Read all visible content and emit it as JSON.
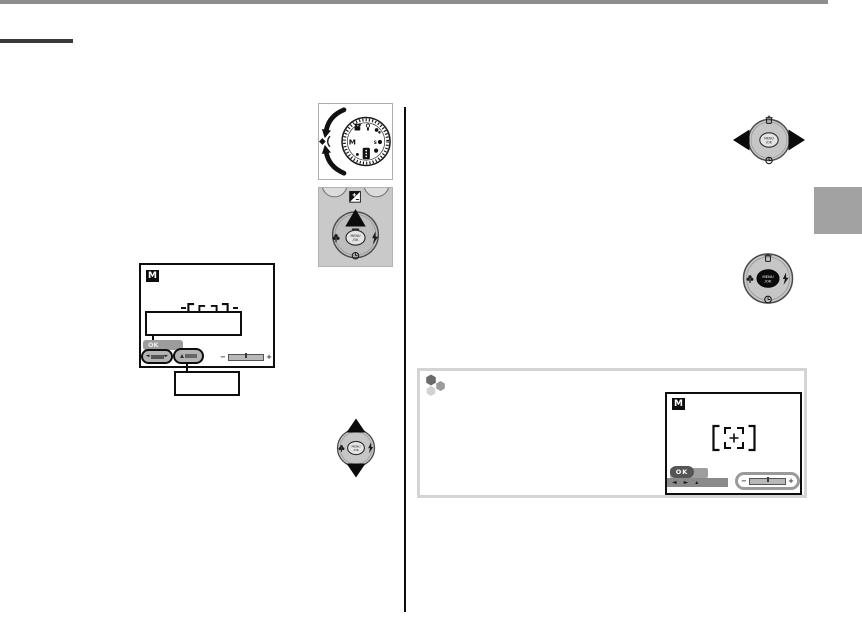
{
  "page": {
    "kind": "camera-manual-page",
    "colors": {
      "top_rule": "#8d8d8d",
      "heading_rule": "#3a3a3a",
      "divider": "#0d0d0d",
      "side_tab": "#a2a2a2",
      "tip_border": "#d4d4d4",
      "control_panel_bg": "#c9c9c9",
      "screen_border": "#0d0d0d"
    }
  },
  "labels": {
    "menu_line1": "MENU",
    "menu_line2": "/OK",
    "mode_m": "M",
    "ok": "OK",
    "minus": "−",
    "plus": "+"
  },
  "left_column": {
    "screen": {
      "mode_badge": "M",
      "ok_label": "OK",
      "shutter_field": {
        "left": "◄",
        "right": "►"
      },
      "slider": {
        "minus": "−",
        "plus": "+"
      }
    }
  },
  "tip_box": {
    "note_icon": "hexagon-cluster-icon",
    "screen": {
      "mode_badge": "M",
      "ok_label": "OK",
      "nav": {
        "left": "◄",
        "right": "►",
        "up": "▴"
      },
      "slider": {
        "minus": "−",
        "plus": "+"
      }
    }
  }
}
